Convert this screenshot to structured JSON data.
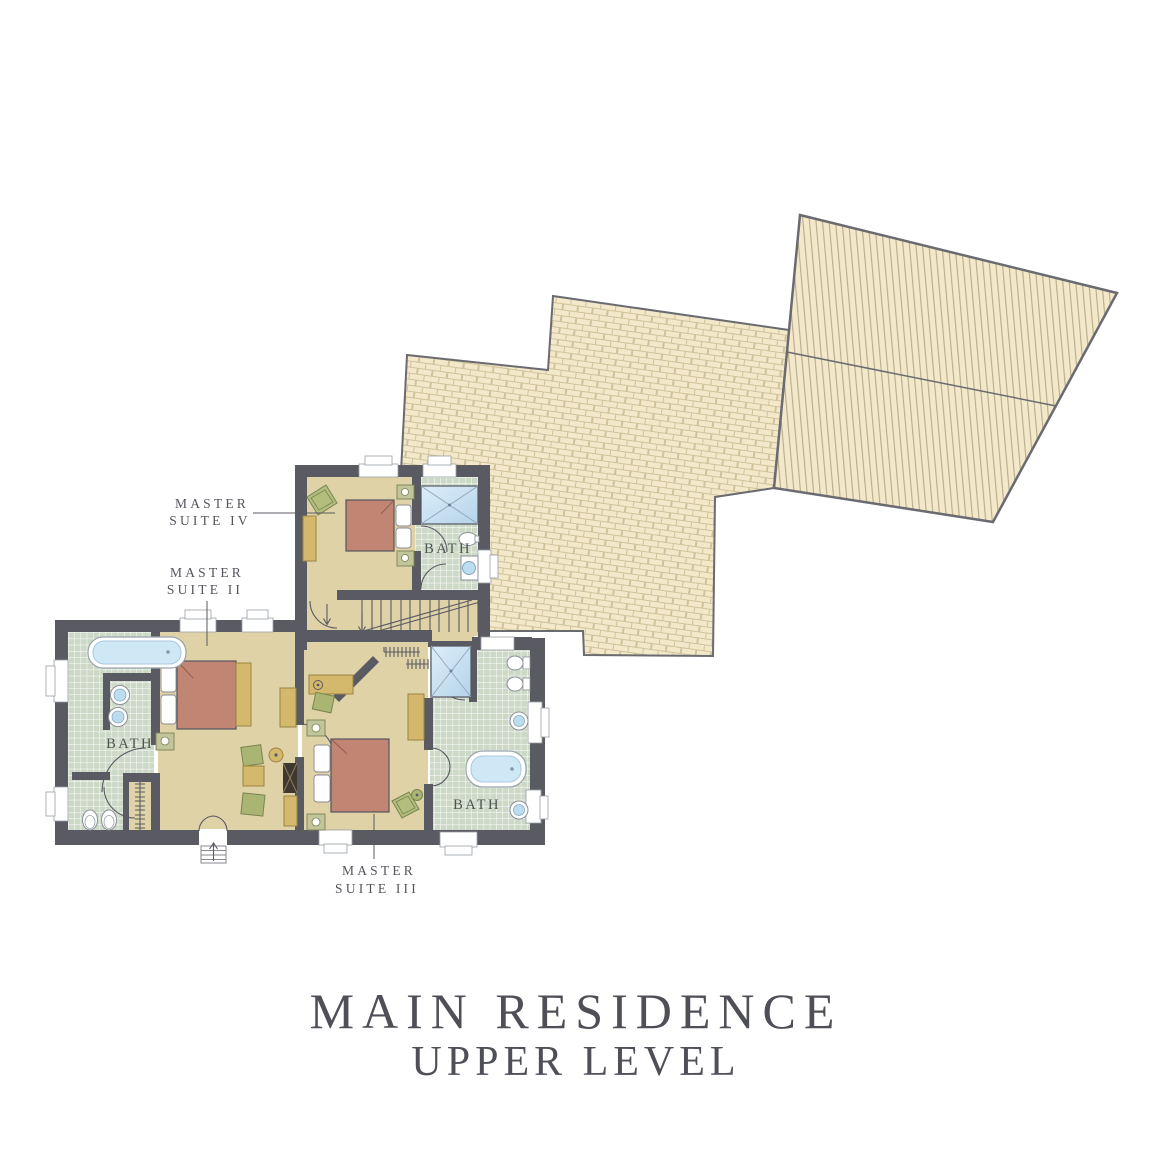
{
  "title": {
    "line1": "MAIN RESIDENCE",
    "line2": "UPPER LEVEL"
  },
  "labels": {
    "suite4": {
      "line1": "MASTER",
      "line2": "SUITE IV"
    },
    "suite2": {
      "line1": "MASTER",
      "line2": "SUITE II"
    },
    "suite3": {
      "line1": "MASTER",
      "line2": "SUITE III"
    },
    "bath4": "BATH",
    "bath2": "BATH",
    "bath3": "BATH"
  },
  "colors": {
    "wall": "#5a5a63",
    "floor": "#ded2a6",
    "tile": "#cdd9c7",
    "roof_base": "#f3e9ca",
    "roof_shingle_line": "#cfc39b",
    "roof_stripe_line": "#b6ab8b",
    "roof_outline": "#6a6a71",
    "bed": "#c08573",
    "wood": "#d4b96d",
    "seating_green": "#aab573",
    "water_blue": "#cfe8f6",
    "text": "#54545e"
  }
}
